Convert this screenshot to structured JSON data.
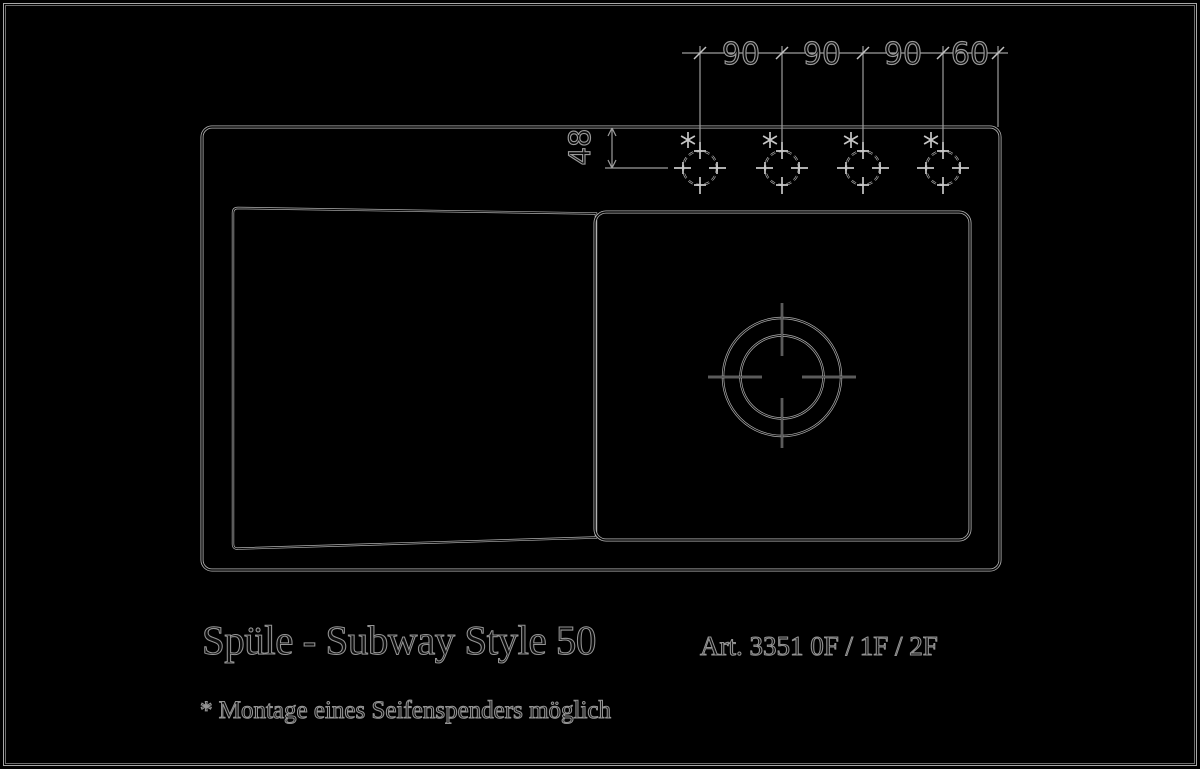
{
  "page": {
    "background": "#000000",
    "frame_color": "#a8a8a8"
  },
  "drawing": {
    "title": "Spüle - Subway Style 50",
    "article": "Art. 3351 0F / 1F / 2F",
    "footnote": "* Montage eines Seifenspenders möglich",
    "dimensions": {
      "top": [
        "90",
        "90",
        "90",
        "60"
      ],
      "side": "48"
    },
    "colors": {
      "line": "#b6b6b6",
      "dim_line": "#9d9d9d",
      "text_outline": "#949494"
    }
  }
}
